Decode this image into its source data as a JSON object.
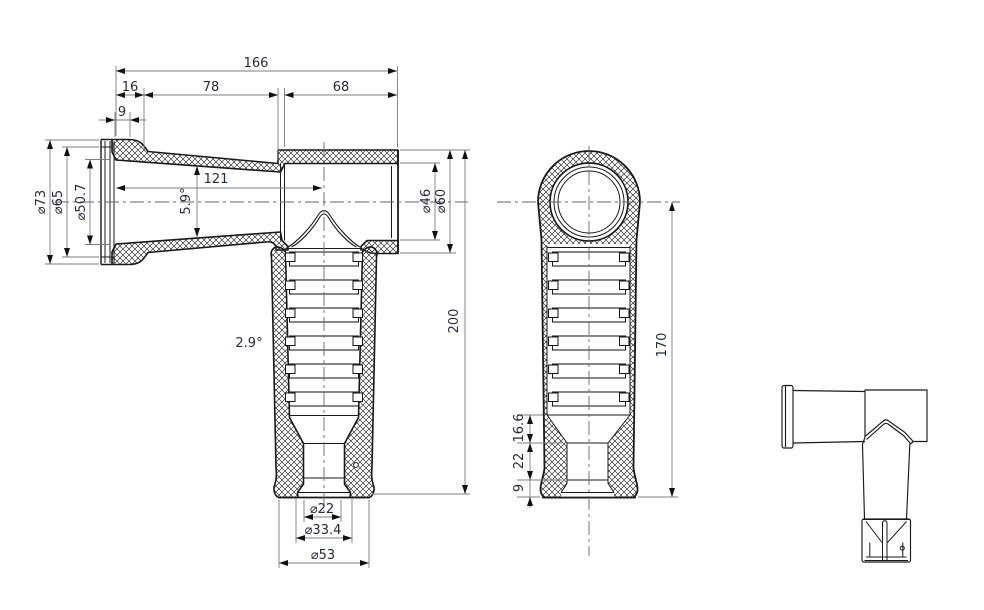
{
  "drawing": {
    "colors": {
      "background": "#ffffff",
      "part_line": "#1a1a1a",
      "dim_line": "#7d7d7d",
      "dim_text": "#262b3d"
    },
    "dims": {
      "overall_length": "166",
      "lip_length": "16",
      "taper_length": "78",
      "socket_length": "68",
      "lip_width": "9",
      "bore_depth": "121",
      "bore_taper_angle": "5.9°",
      "flange_od": "⌀73",
      "lip_od": "⌀65",
      "bore_id": "⌀50.7",
      "socket_id": "⌀46",
      "socket_od": "⌀60",
      "overall_height": "200",
      "leg_taper_angle": "2.9°",
      "tip_bore": "⌀22",
      "tip_mid_od": "⌀33.4",
      "base_od": "⌀53",
      "side_height": "170",
      "funnel_height": "16.6",
      "tip_height": "22",
      "base_height": "9"
    }
  }
}
